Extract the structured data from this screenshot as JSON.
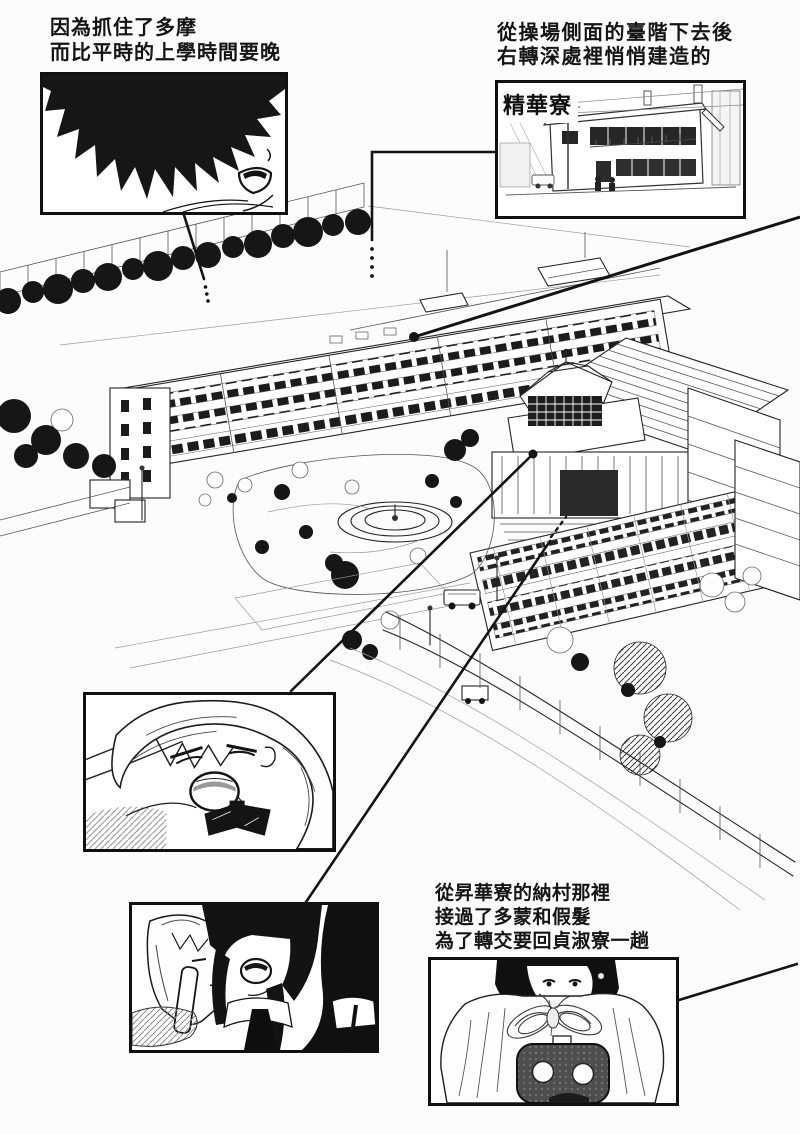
{
  "page": {
    "kind": "manga-page",
    "paper_color": "#fcfcfa",
    "ink_color": "#141414"
  },
  "captions": {
    "top_left": {
      "text": "因為抓住了多摩\n而比平時的上學時間要晚"
    },
    "top_right": {
      "text": "從操場側面的臺階下去後\n右轉深處裡悄悄建造的"
    },
    "bottom_right": {
      "text": "從昇華寮的納村那裡\n接過了多蒙和假髮\n為了轉交要回貞淑寮一趟"
    }
  },
  "labels": {
    "dorm_sign": "精華寮"
  },
  "panels": [
    {
      "id": "boy-closeup",
      "alt": "黑髮少年側臉特寫"
    },
    {
      "id": "seika-dorm",
      "alt": "精華寮外觀"
    },
    {
      "id": "blonde-girl",
      "alt": "金髮少女大喊"
    },
    {
      "id": "two-girls",
      "alt": "兩名學生"
    },
    {
      "id": "wig-domon",
      "alt": "抱著假髮和多蒙的少女"
    }
  ]
}
